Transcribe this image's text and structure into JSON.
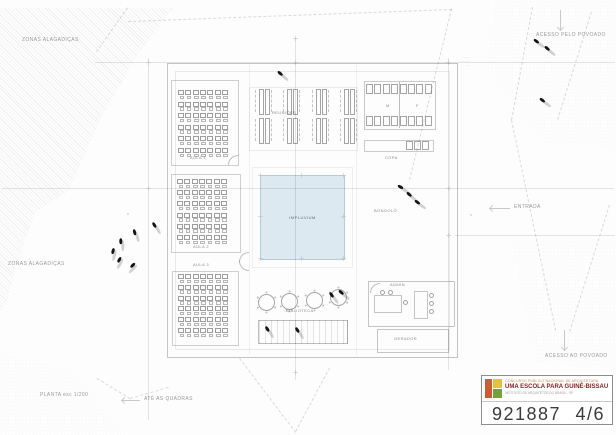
{
  "sheet": {
    "bg": "#fdfdfd"
  },
  "impluvium": {
    "label": "IMPLUVIUM",
    "fill": "#dce9f0",
    "border": "#b5ccd9"
  },
  "red_note": {
    "l1": "·······",
    "l2": "·········",
    "l3": "····"
  },
  "titleblock": {
    "line1": "CONCURSO PÚBLICO NACIONAL DE ARQUITETURA",
    "line2": "UMA ESCOLA PARA GUINÉ-BISSAU",
    "line3": "INSTITUTO DE ARQUITETOS DO BRASIL - SP",
    "number": "921887",
    "sheet": "4/6",
    "logo_orange": "#cf5b2e",
    "logo_yellow": "#e5c334",
    "logo_green": "#74a13e",
    "line1_color": "#c98a50",
    "line2_color": "#8a2020"
  },
  "labels": [
    {
      "t": "ZONAS ALAGADIÇAS",
      "x": 22,
      "y": 38,
      "s": 5
    },
    {
      "t": "ZONAS ALAGADIÇAS",
      "x": 8,
      "y": 262,
      "s": 5
    },
    {
      "t": "ACESSO PELO POVOADO",
      "x": 536,
      "y": 33,
      "s": 5
    },
    {
      "t": "ENTRADA",
      "x": 514,
      "y": 205,
      "s": 5
    },
    {
      "t": "ACESSO AO POVOADO",
      "x": 545,
      "y": 354,
      "s": 5
    },
    {
      "t": "PLANTA esc 1/200",
      "x": 40,
      "y": 393,
      "s": 5
    },
    {
      "t": "ATÉ AS QUADRAS",
      "x": 144,
      "y": 397,
      "s": 5
    },
    {
      "t": "AULA 1",
      "x": 190,
      "y": 156,
      "s": 4,
      "c": "#8c8c8c"
    },
    {
      "t": "AULA 2",
      "x": 193,
      "y": 245,
      "s": 4,
      "c": "#8c8c8c"
    },
    {
      "t": "AULA 3",
      "x": 193,
      "y": 263,
      "s": 4,
      "c": "#8c8c8c"
    },
    {
      "t": "REUNIÕES",
      "x": 272,
      "y": 111,
      "s": 4,
      "c": "#8c8c8c"
    },
    {
      "t": "M",
      "x": 386,
      "y": 104,
      "s": 4,
      "c": "#8c8c8c"
    },
    {
      "t": "F",
      "x": 416,
      "y": 104,
      "s": 4,
      "c": "#8c8c8c"
    },
    {
      "t": "COPA",
      "x": 385,
      "y": 156,
      "s": 4,
      "c": "#8c8c8c"
    },
    {
      "t": "BONGOLÔ",
      "x": 374,
      "y": 209,
      "s": 4,
      "c": "#8c8c8c"
    },
    {
      "t": "BIBLIOTECA",
      "x": 286,
      "y": 309,
      "s": 4,
      "c": "#8c8c8c"
    },
    {
      "t": "ADMIN",
      "x": 390,
      "y": 283,
      "s": 4,
      "c": "#8c8c8c"
    },
    {
      "t": "GERADOR",
      "x": 394,
      "y": 337,
      "s": 4,
      "c": "#8c8c8c"
    },
    {
      "t": "v",
      "x": 127,
      "y": 212,
      "s": 4,
      "c": "#a8a8a8"
    },
    {
      "t": "v",
      "x": 470,
      "y": 213,
      "s": 4,
      "c": "#a8a8a8"
    }
  ],
  "solid_lines": [
    {
      "x": 148,
      "y": 58,
      "len": 362,
      "v": 1
    },
    {
      "x": 295,
      "y": 38,
      "len": 342,
      "v": 1
    },
    {
      "x": 448,
      "y": 58,
      "len": 312,
      "v": 1
    },
    {
      "x": 95,
      "y": 62,
      "len": 520
    },
    {
      "x": 2,
      "y": 188,
      "len": 612
    },
    {
      "x": 455,
      "y": 235,
      "len": 160
    },
    {
      "x": 399,
      "y": 82,
      "len": 46,
      "v": 1,
      "c": "rgba(0,0,0,0.25)"
    },
    {
      "x": 249,
      "y": 64,
      "len": 291,
      "v": 1,
      "c": "rgba(0,0,0,0.05)"
    },
    {
      "x": 356,
      "y": 64,
      "len": 291,
      "v": 1,
      "c": "rgba(0,0,0,0.05)"
    }
  ],
  "dashed_lines": [
    {
      "x1": 128,
      "y1": 8,
      "x2": 97,
      "y2": 52
    },
    {
      "x1": 128,
      "y1": 21,
      "x2": 452,
      "y2": 9
    },
    {
      "x1": 452,
      "y1": 9,
      "x2": 410,
      "y2": 180
    },
    {
      "x1": 533,
      "y1": 7,
      "x2": 512,
      "y2": 120
    },
    {
      "x1": 512,
      "y1": 120,
      "x2": 556,
      "y2": 330
    },
    {
      "x1": 592,
      "y1": 12,
      "x2": 558,
      "y2": 120
    },
    {
      "x1": 610,
      "y1": 205,
      "x2": 570,
      "y2": 332
    },
    {
      "x1": 97,
      "y1": 378,
      "x2": 130,
      "y2": 398
    },
    {
      "x1": 130,
      "y1": 398,
      "x2": 168,
      "y2": 387
    },
    {
      "x1": 240,
      "y1": 358,
      "x2": 296,
      "y2": 432
    },
    {
      "x1": 330,
      "y1": 368,
      "x2": 296,
      "y2": 432
    }
  ],
  "ticks": [
    {
      "x": 148,
      "y": 62
    },
    {
      "x": 295,
      "y": 62
    },
    {
      "x": 448,
      "y": 62
    },
    {
      "x": 148,
      "y": 188
    },
    {
      "x": 448,
      "y": 188
    },
    {
      "x": 295,
      "y": 372
    },
    {
      "x": 448,
      "y": 235
    },
    {
      "x": 295,
      "y": 38
    },
    {
      "x": 260,
      "y": 175
    },
    {
      "x": 301,
      "y": 175
    },
    {
      "x": 343,
      "y": 175
    },
    {
      "x": 260,
      "y": 216
    },
    {
      "x": 343,
      "y": 216
    },
    {
      "x": 260,
      "y": 258
    },
    {
      "x": 301,
      "y": 258
    },
    {
      "x": 343,
      "y": 258
    }
  ],
  "outlines": [
    {
      "x": 167,
      "y": 63,
      "w": 289,
      "h": 293,
      "c": "rgba(0,0,0,0.22)"
    },
    {
      "x": 175,
      "y": 71,
      "w": 273,
      "h": 277,
      "c": "rgba(0,0,0,0.08)"
    },
    {
      "x": 171,
      "y": 80,
      "w": 66,
      "h": 84,
      "c": "rgba(0,0,0,0.18)"
    },
    {
      "x": 171,
      "y": 174,
      "w": 68,
      "h": 77,
      "c": "rgba(0,0,0,0.18)"
    },
    {
      "x": 172,
      "y": 271,
      "w": 65,
      "h": 73,
      "c": "rgba(0,0,0,0.18)"
    },
    {
      "x": 249,
      "y": 87,
      "w": 107,
      "h": 62,
      "c": "rgba(0,0,0,0.07)"
    },
    {
      "x": 364,
      "y": 81,
      "w": 70,
      "h": 47,
      "c": "rgba(0,0,0,0.20)"
    },
    {
      "x": 364,
      "y": 140,
      "w": 68,
      "h": 10,
      "c": "rgba(0,0,0,0.20)"
    },
    {
      "x": 368,
      "y": 281,
      "w": 85,
      "h": 44,
      "c": "rgba(0,0,0,0.22)"
    },
    {
      "x": 377,
      "y": 329,
      "w": 70,
      "h": 22,
      "c": "rgba(0,0,0,0.22)"
    },
    {
      "x": 252,
      "y": 167,
      "w": 99,
      "h": 99,
      "c": "rgba(0,0,0,0.06)"
    },
    {
      "x": 374,
      "y": 295,
      "w": 26,
      "h": 16,
      "c": "rgba(0,0,0,0.22)"
    },
    {
      "x": 414,
      "y": 291,
      "w": 12,
      "h": 26,
      "c": "rgba(0,0,0,0.22)"
    }
  ],
  "desk_grids": [
    {
      "x": 178,
      "y": 90,
      "cols": 7,
      "rows": 6,
      "cw": 7.3,
      "ch": 11.6
    },
    {
      "x": 177,
      "y": 179,
      "cols": 7,
      "rows": 6,
      "cw": 7.3,
      "ch": 11.2
    },
    {
      "x": 178,
      "y": 274,
      "cols": 7,
      "rows": 6,
      "cw": 7.3,
      "ch": 10.8
    }
  ],
  "meeting_tables": [
    {
      "cx": 264,
      "y": 89
    },
    {
      "cx": 292,
      "y": 89
    },
    {
      "cx": 321,
      "y": 89
    },
    {
      "cx": 349,
      "y": 89
    },
    {
      "cx": 264,
      "y": 118
    },
    {
      "cx": 292,
      "y": 118
    },
    {
      "cx": 321,
      "y": 118
    },
    {
      "cx": 349,
      "y": 118
    }
  ],
  "fixture_rows": [
    {
      "x": 366,
      "y": 84,
      "n": 8,
      "w": 5,
      "h": 8,
      "p": 8.4
    },
    {
      "x": 366,
      "y": 116,
      "n": 8,
      "w": 5,
      "h": 8,
      "p": 8.4
    },
    {
      "x": 406,
      "y": 141,
      "n": 3,
      "w": 5,
      "h": 7,
      "p": 8
    }
  ],
  "round_tables": [
    {
      "x": 258,
      "y": 294
    },
    {
      "x": 281,
      "y": 293
    },
    {
      "x": 306,
      "y": 292
    },
    {
      "x": 330,
      "y": 289
    }
  ],
  "chair_dots": [
    {
      "x": 380,
      "y": 290
    },
    {
      "x": 388,
      "y": 290
    },
    {
      "x": 403,
      "y": 300
    },
    {
      "x": 429,
      "y": 293
    },
    {
      "x": 429,
      "y": 301
    },
    {
      "x": 429,
      "y": 309
    }
  ],
  "door_arcs": [
    {
      "x": 228,
      "y": 155,
      "r": 9,
      "q": "tl"
    },
    {
      "x": 239,
      "y": 252,
      "r": 9,
      "q": "tl"
    },
    {
      "x": 239,
      "y": 261,
      "r": 9,
      "q": "bl"
    },
    {
      "x": 370,
      "y": 283,
      "r": 9,
      "q": "tl"
    }
  ],
  "figures": [
    {
      "x": 278,
      "y": 70,
      "a": 40
    },
    {
      "x": 534,
      "y": 38,
      "a": 35
    },
    {
      "x": 545,
      "y": 45,
      "a": 40
    },
    {
      "x": 540,
      "y": 97,
      "a": 35
    },
    {
      "x": 398,
      "y": 184,
      "a": 30
    },
    {
      "x": 407,
      "y": 191,
      "a": 40
    },
    {
      "x": 415,
      "y": 199,
      "a": 35
    },
    {
      "x": 153,
      "y": 221,
      "a": 60
    },
    {
      "x": 134,
      "y": 228,
      "a": 75
    },
    {
      "x": 121,
      "y": 237,
      "a": 90
    },
    {
      "x": 114,
      "y": 247,
      "a": 105
    },
    {
      "x": 121,
      "y": 256,
      "a": 120
    },
    {
      "x": 135,
      "y": 262,
      "a": 135
    },
    {
      "x": 330,
      "y": 291,
      "a": 55
    },
    {
      "x": 339,
      "y": 289,
      "a": 40
    },
    {
      "x": 266,
      "y": 325,
      "a": 60
    },
    {
      "x": 296,
      "y": 326,
      "a": 60
    }
  ],
  "arrows": [
    {
      "x": 560,
      "y": 10,
      "dir": "down",
      "len": 20
    },
    {
      "x": 490,
      "y": 208,
      "dir": "left",
      "len": 20
    },
    {
      "x": 122,
      "y": 400,
      "dir": "left",
      "len": 18
    },
    {
      "x": 564,
      "y": 330,
      "dir": "down",
      "len": 20
    }
  ]
}
